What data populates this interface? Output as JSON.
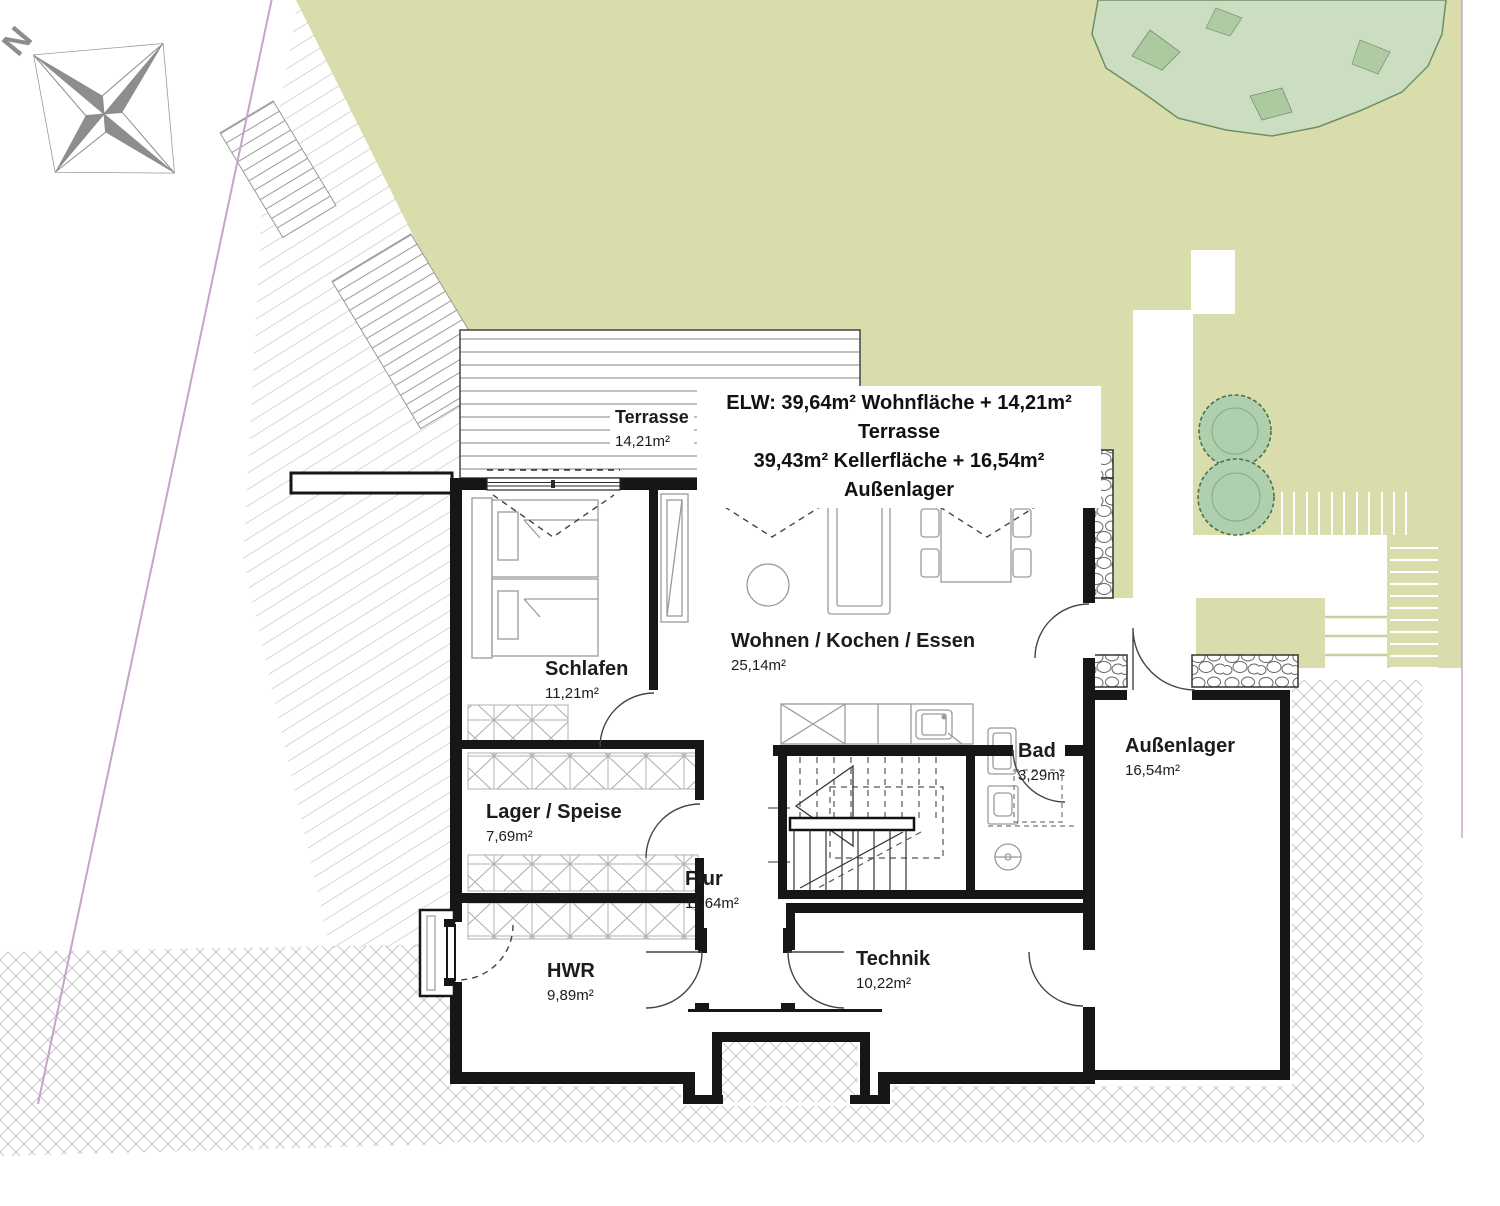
{
  "title": {
    "line1": "ELW: 39,64m² Wohnfläche + 14,21m² Terrasse",
    "line2": "39,43m² Kellerfläche + 16,54m² Außenlager"
  },
  "compass": {
    "north_label": "N"
  },
  "rooms": {
    "terrasse": {
      "name": "Terrasse",
      "area": "14,21m²"
    },
    "schlafen": {
      "name": "Schlafen",
      "area": "11,21m²"
    },
    "wohnen": {
      "name": "Wohnen / Kochen / Essen",
      "area": "25,14m²"
    },
    "bad": {
      "name": "Bad",
      "area": "3,29m²"
    },
    "aussenlager": {
      "name": "Außenlager",
      "area": "16,54m²"
    },
    "lager": {
      "name": "Lager / Speise",
      "area": "7,69m²"
    },
    "flur": {
      "name": "Flur",
      "area": "11,64m²"
    },
    "hwr": {
      "name": "HWR",
      "area": "9,89m²"
    },
    "technik": {
      "name": "Technik",
      "area": "10,22m²"
    }
  },
  "colors": {
    "garden": "#d9ddac",
    "tree": "#cbdfc4",
    "bush": "#aed0ae",
    "wall": "#161616",
    "boundary": "#c6a3c8",
    "hatch": "#bdbdbd"
  }
}
